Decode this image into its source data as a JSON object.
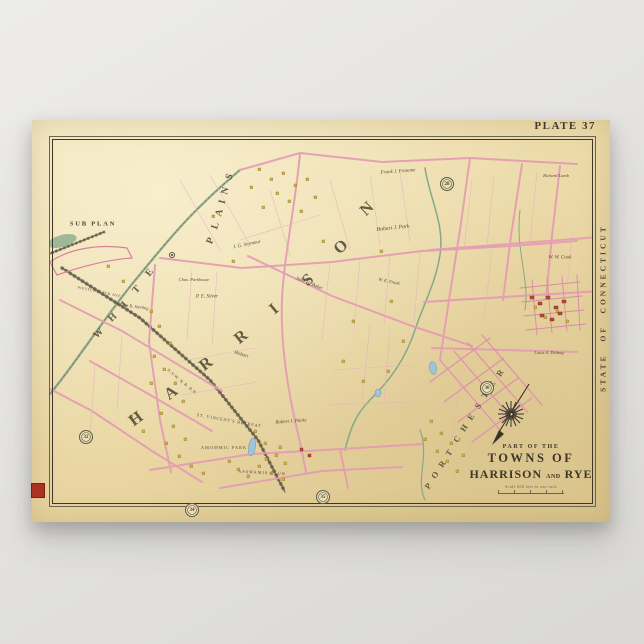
{
  "poster": {
    "plate_label": "PLATE 37",
    "sub_plan_label": "SUB PLAN",
    "state_edge_label": "STATE OF CONNECTICUT",
    "edge_mark_color": "#a83323",
    "paper_color": "#ead7a4",
    "road_color": "#e49cb2",
    "water_color": "#9fc4d8",
    "boundary_green": "#7d9f85",
    "title": {
      "kicker": "PART OF THE",
      "line1": "TOWNS OF",
      "line2_left": "HARRISON",
      "line2_mid": "AND",
      "line2_right": "RYE",
      "scale_note": "Scale 600 feet to one inch"
    },
    "plate_refs": [
      {
        "n": "28",
        "x": 415,
        "y": 64
      },
      {
        "n": "30",
        "x": 455,
        "y": 268
      },
      {
        "n": "32",
        "x": 54,
        "y": 317
      },
      {
        "n": "34",
        "x": 160,
        "y": 390
      },
      {
        "n": "35",
        "x": 291,
        "y": 377
      }
    ],
    "big_names": [
      {
        "name": "WHITE PLAINS",
        "s": 10,
        "letters": [
          {
            "ch": "W",
            "x": 67,
            "y": 214,
            "r": -44
          },
          {
            "ch": "H",
            "x": 81,
            "y": 198,
            "r": -44
          },
          {
            "ch": "I",
            "x": 93,
            "y": 185,
            "r": -46
          },
          {
            "ch": "T",
            "x": 105,
            "y": 170,
            "r": -48
          },
          {
            "ch": "E",
            "x": 118,
            "y": 153,
            "r": -52
          },
          {
            "ch": "P",
            "x": 179,
            "y": 121,
            "r": -68
          },
          {
            "ch": "L",
            "x": 184,
            "y": 106,
            "r": -72
          },
          {
            "ch": "A",
            "x": 188,
            "y": 93,
            "r": -75
          },
          {
            "ch": "I",
            "x": 191,
            "y": 82,
            "r": -76
          },
          {
            "ch": "N",
            "x": 194,
            "y": 71,
            "r": -74
          },
          {
            "ch": "S",
            "x": 198,
            "y": 57,
            "r": -66
          }
        ]
      },
      {
        "name": "HARRISON",
        "s": 16.5,
        "letters": [
          {
            "ch": "H",
            "x": 104,
            "y": 299,
            "r": -37
          },
          {
            "ch": "A",
            "x": 139,
            "y": 273,
            "r": -38
          },
          {
            "ch": "R",
            "x": 174,
            "y": 244,
            "r": -38
          },
          {
            "ch": "R",
            "x": 209,
            "y": 217,
            "r": -39
          },
          {
            "ch": "I",
            "x": 242,
            "y": 189,
            "r": -40
          },
          {
            "ch": "S",
            "x": 276,
            "y": 160,
            "r": -40
          },
          {
            "ch": "O",
            "x": 309,
            "y": 127,
            "r": -42
          },
          {
            "ch": "N",
            "x": 335,
            "y": 89,
            "r": -44
          }
        ]
      },
      {
        "name": "PORT CHESTER",
        "s": 8.5,
        "letters": [
          {
            "ch": "P",
            "x": 396,
            "y": 366,
            "r": -56
          },
          {
            "ch": "O",
            "x": 403,
            "y": 355,
            "r": -56
          },
          {
            "ch": "R",
            "x": 410,
            "y": 344,
            "r": -56
          },
          {
            "ch": "T",
            "x": 417,
            "y": 333,
            "r": -56
          },
          {
            "ch": "C",
            "x": 425,
            "y": 319,
            "r": -57
          },
          {
            "ch": "H",
            "x": 432,
            "y": 308,
            "r": -57
          },
          {
            "ch": "E",
            "x": 439,
            "y": 297,
            "r": -57
          },
          {
            "ch": "S",
            "x": 446,
            "y": 286,
            "r": -57
          },
          {
            "ch": "T",
            "x": 453,
            "y": 275,
            "r": -57
          },
          {
            "ch": "E",
            "x": 460,
            "y": 264,
            "r": -57
          },
          {
            "ch": "R",
            "x": 468,
            "y": 253,
            "r": -57
          }
        ]
      }
    ],
    "labels": [
      {
        "t": "Frank J. Fromme",
        "x": 366,
        "y": 52,
        "r": -4,
        "s": 5,
        "it": 1
      },
      {
        "t": "Richard Lamb",
        "x": 524,
        "y": 56,
        "r": 0,
        "s": 4.5,
        "it": 1
      },
      {
        "t": "Hobart J. Park",
        "x": 361,
        "y": 109,
        "r": -6,
        "s": 5.5,
        "it": 1
      },
      {
        "t": "J. G. Seymour",
        "x": 215,
        "y": 125,
        "r": -12,
        "s": 5,
        "it": 1
      },
      {
        "t": "W. W. Cook",
        "x": 528,
        "y": 138,
        "r": 0,
        "s": 5,
        "it": 1
      },
      {
        "t": "Chas. Parkhouse",
        "x": 162,
        "y": 160,
        "r": 0,
        "s": 4.5,
        "it": 1
      },
      {
        "t": "P. E. Silver",
        "x": 175,
        "y": 177,
        "r": 0,
        "s": 5,
        "it": 1
      },
      {
        "t": "John H. Baker",
        "x": 277,
        "y": 164,
        "r": 22,
        "s": 5,
        "it": 1
      },
      {
        "t": "W. E. Frank",
        "x": 357,
        "y": 162,
        "r": 12,
        "s": 4.5,
        "it": 1
      },
      {
        "t": "John B. Sterling",
        "x": 102,
        "y": 187,
        "r": 8,
        "s": 4.5,
        "it": 1
      },
      {
        "t": "Hobart",
        "x": 209,
        "y": 235,
        "r": 18,
        "s": 5,
        "it": 1
      },
      {
        "t": "Louis A. Delang",
        "x": 517,
        "y": 233,
        "r": 0,
        "s": 4.5,
        "it": 1
      },
      {
        "t": "ST. VINCENT'S RETREAT",
        "x": 197,
        "y": 301,
        "r": 10,
        "s": 4.3,
        "sp": 0.8
      },
      {
        "t": "AMOMMIC PARK",
        "x": 192,
        "y": 328,
        "r": 0,
        "s": 4.3,
        "sp": 1
      },
      {
        "t": "Robert J. Parks",
        "x": 259,
        "y": 302,
        "r": -4,
        "s": 5,
        "it": 1
      },
      {
        "t": "APAWAMIS CLUB",
        "x": 230,
        "y": 353,
        "r": 3,
        "s": 4.3,
        "sp": 1
      },
      {
        "t": "WESTCHESTER AVE.",
        "x": 68,
        "y": 173,
        "r": 12,
        "s": 3.8,
        "sp": 0.6
      },
      {
        "t": "N.Y.W. & B. R.R.",
        "x": 150,
        "y": 262,
        "r": 40,
        "s": 4.2,
        "sp": 0.5
      }
    ]
  }
}
